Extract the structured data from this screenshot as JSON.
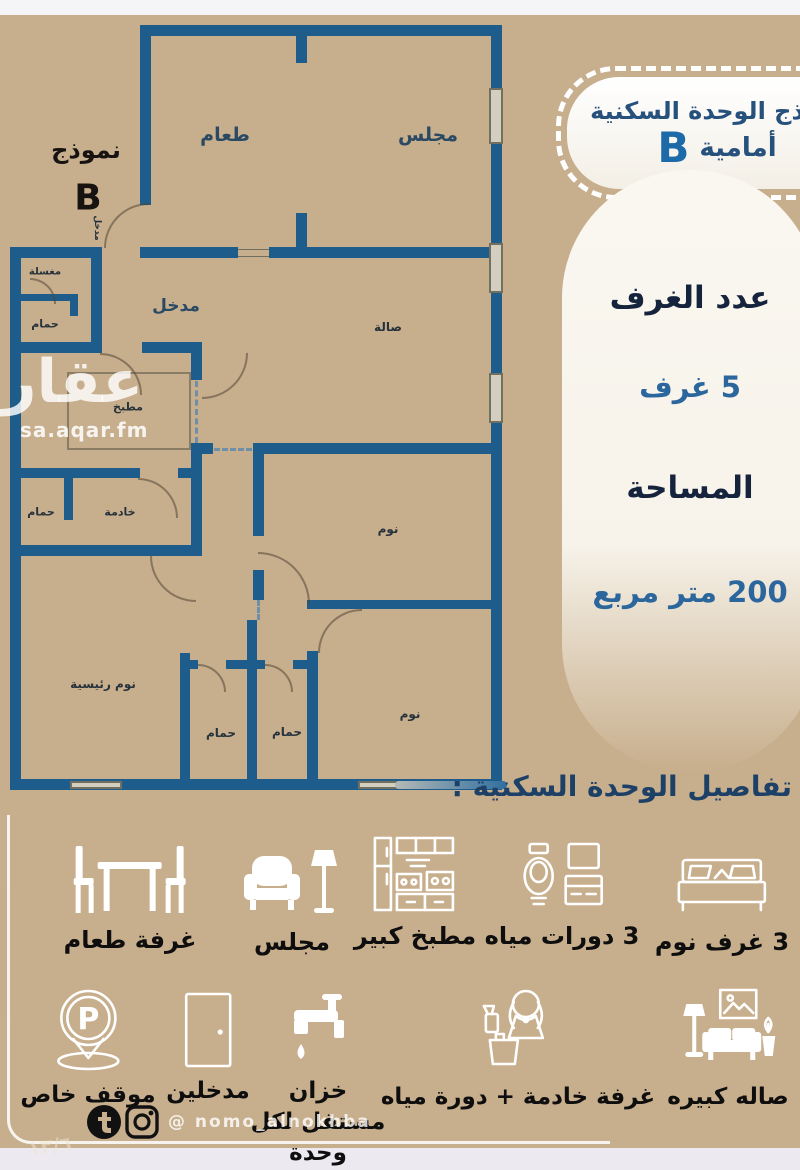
{
  "badge": {
    "line1": "نموذج الوحدة السكنية",
    "line2": "أمامية",
    "letter": "B"
  },
  "corner_model": {
    "label": "نموذج",
    "letter": "B"
  },
  "watermark": {
    "name": "عقار",
    "site": "sa.aqar.fm"
  },
  "info_panel": {
    "rooms_label": "عدد الغرف",
    "rooms_value": "5  غرف",
    "area_label": "المساحة",
    "area_value": "200 متر مربع"
  },
  "details_heading": "تفاصيل الوحدة السكنية :",
  "floorplan": {
    "rooms": {
      "dining": "طعام",
      "majlis": "مجلس",
      "entrance": "مدخل",
      "entrance_door": "مدخل",
      "laundry": "مغسلة",
      "bath_top": "حمام",
      "kitchen": "مطبخ",
      "hall": "صالة",
      "bedroom_mid": "نوم",
      "maid_bath": "حمام",
      "maid_room": "خادمة",
      "master_bedroom": "نوم رئيسية",
      "bath_a": "حمام",
      "bath_b": "حمام",
      "bedroom_bottom": "نوم"
    }
  },
  "features_row1": [
    {
      "icon": "bed-icon",
      "label": "3 غرف نوم"
    },
    {
      "icon": "toilet-icon",
      "label": "3 دورات مياه"
    },
    {
      "icon": "kitchen-icon",
      "label": "مطبخ كبير"
    },
    {
      "icon": "armchair-lamp-icon",
      "label": "مجلس"
    },
    {
      "icon": "dining-table-icon",
      "label": "غرفة طعام"
    }
  ],
  "features_row2": [
    {
      "icon": "living-room-icon",
      "label": "صاله كبيره"
    },
    {
      "icon": "maid-icon",
      "label": "غرفة خادمة + دورة مياه"
    },
    {
      "icon": "water-tank-icon",
      "label": "خزان مستقل لكل وحدة"
    },
    {
      "icon": "door-icon",
      "label": "مدخلين"
    },
    {
      "icon": "parking-icon",
      "label": "موقف خاص"
    }
  ],
  "social": {
    "handle": "@ nomo_alnokhba",
    "page_note": "١٣/٦"
  },
  "colors": {
    "background": "#c7ae8c",
    "wall": "#1e5c8c",
    "navy": "#15233d",
    "accent_blue": "#2b679c",
    "white": "#ffffff"
  }
}
